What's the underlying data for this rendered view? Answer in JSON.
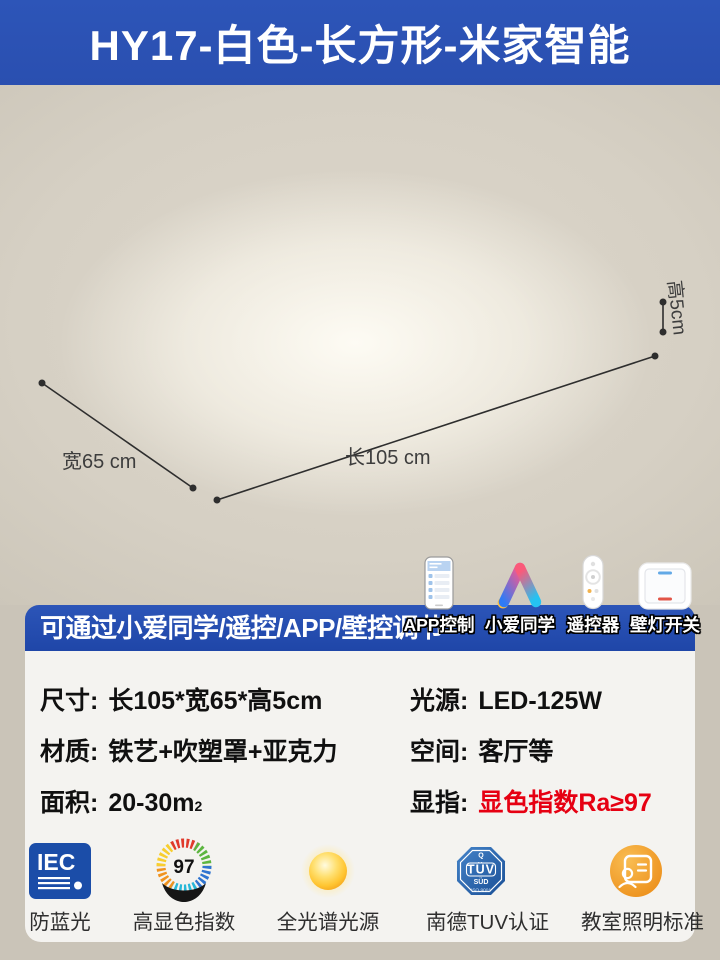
{
  "header": {
    "title": "HY17-白色-长方形-米家智能"
  },
  "photo": {
    "dim_height_label": "高5cm",
    "dim_width_label": "宽65 cm",
    "dim_length_label": "长105 cm"
  },
  "banner": {
    "text": "可通过小爱同学/遥控/APP/壁控调节",
    "methods": [
      {
        "icon": "app-phone-icon",
        "label": "APP控制"
      },
      {
        "icon": "xiaoai-icon",
        "label": "小爱同学"
      },
      {
        "icon": "remote-icon",
        "label": "遥控器"
      },
      {
        "icon": "wall-switch-icon",
        "label": "壁灯开关"
      }
    ]
  },
  "specs": {
    "rows": [
      {
        "left": {
          "label": "尺寸:",
          "value": "长105*宽65*高5cm"
        },
        "right": {
          "label": "光源:",
          "value": "LED-125W"
        }
      },
      {
        "left": {
          "label": "材质:",
          "value": "铁艺+吹塑罩+亚克力"
        },
        "right": {
          "label": "空间:",
          "value": "客厅等"
        }
      },
      {
        "left": {
          "label": "面积:",
          "value": "20-30m",
          "sup": "2"
        },
        "right": {
          "label": "显指:",
          "value": "显色指数Ra≥97"
        }
      }
    ]
  },
  "certs": [
    {
      "icon": "iec-badge-icon",
      "badge_text": "IEC",
      "label": "防蓝光"
    },
    {
      "icon": "cri-ring-icon",
      "badge_text": "97",
      "label": "高显色指数"
    },
    {
      "icon": "sun-icon",
      "label": "全光谱光源"
    },
    {
      "icon": "tuv-badge-icon",
      "badge_top": "Q",
      "badge_text": "TÜV",
      "badge_sub": "SÜD",
      "badge_small": "ISO 9001",
      "label": "南德TUV认证"
    },
    {
      "icon": "classroom-icon",
      "label": "教室照明标准"
    }
  ],
  "colors": {
    "header_blue": "#2a50b4",
    "banner_blue": "#2148ae",
    "accent_red": "#e60012",
    "lamp_line_tan": "#c3a97a",
    "background_beige": "#d3cdc1"
  }
}
